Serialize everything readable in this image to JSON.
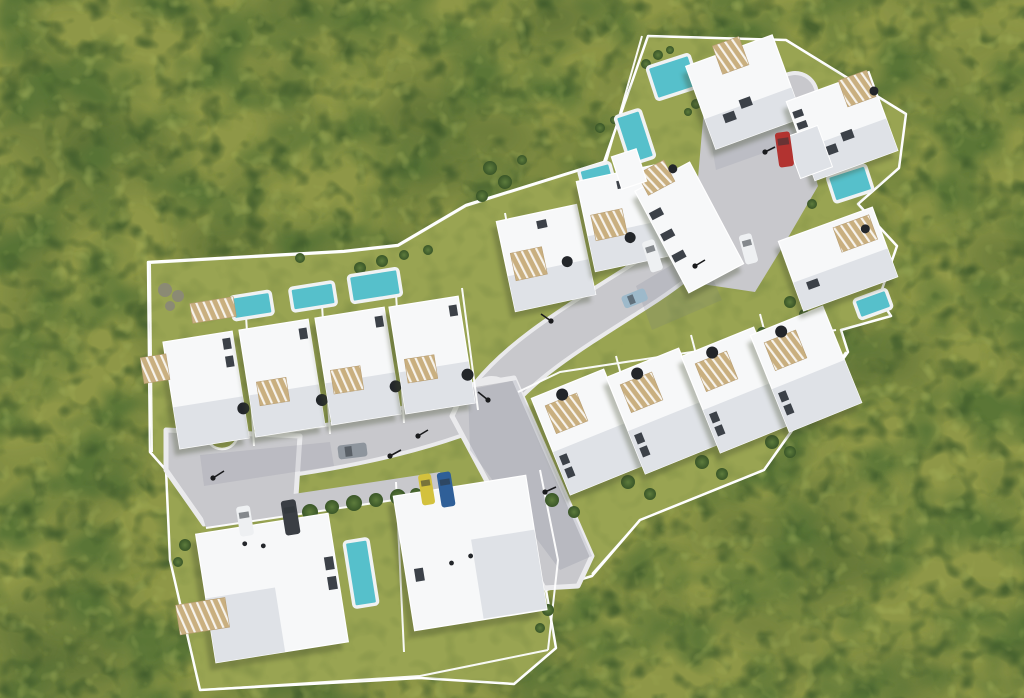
{
  "scene": {
    "description": "Top-down aerial 3D render of a white-villa residential development with swimming pools and grey access roads, surrounded by dense olive-green groves",
    "type": "architectural-render",
    "view": "top-down aerial",
    "site": {
      "clusters": [
        {
          "name": "north-cluster",
          "villas": 6,
          "pools": 4
        },
        {
          "name": "east-row",
          "villas": 4,
          "pools": 1
        },
        {
          "name": "west-row",
          "villas": 4,
          "pools": 3
        },
        {
          "name": "south-cluster",
          "villas": 2,
          "pools": 1
        }
      ],
      "villas_total": 16,
      "pools_total": 9,
      "street_lamps": 8,
      "roads": [
        "northeast access road",
        "west road with wide turning area",
        "southeast dead-end branch",
        "north courtyard"
      ]
    },
    "cars": [
      {
        "color": "red",
        "location": "north courtyard"
      },
      {
        "color": "white",
        "location": "northeast road"
      },
      {
        "color": "white",
        "location": "northeast road"
      },
      {
        "color": "light-blue",
        "location": "northeast road"
      },
      {
        "color": "silver",
        "location": "west road"
      },
      {
        "color": "white",
        "location": "south parking"
      },
      {
        "color": "dark-gray",
        "location": "south parking"
      },
      {
        "color": "yellow",
        "location": "south parking"
      },
      {
        "color": "blue",
        "location": "south parking"
      }
    ]
  },
  "palette": {
    "grassBase": "#8e9747",
    "grassSite": "#99a452",
    "treeDark": "#3d592b",
    "treeMid": "#567336",
    "treeLight": "#aab85e",
    "shrub": "#8b8a74",
    "road": "#c8c8cc",
    "sidewalk": "#eaeaec",
    "wall": "#ffffff",
    "house": "#f7f8f9",
    "houseShade": "#dfe2e7",
    "pergola": "#c9af7f",
    "pool": "#56c0cb",
    "poolDeck": "#f0f2f3",
    "window": "#3c4148",
    "dish": "#23262a",
    "shadowGreen": "#3f4a2a",
    "shadowRoad": "#6f7488",
    "lamp": "#1a1b1d",
    "carRed": "#b23330",
    "carYellow": "#d3c13d",
    "carBlue": "#2f5f98",
    "carLightBlue": "#9db9ca",
    "carWhite": "#eef0f2",
    "carDark": "#3a3e44",
    "carSilver": "#8e959d"
  }
}
